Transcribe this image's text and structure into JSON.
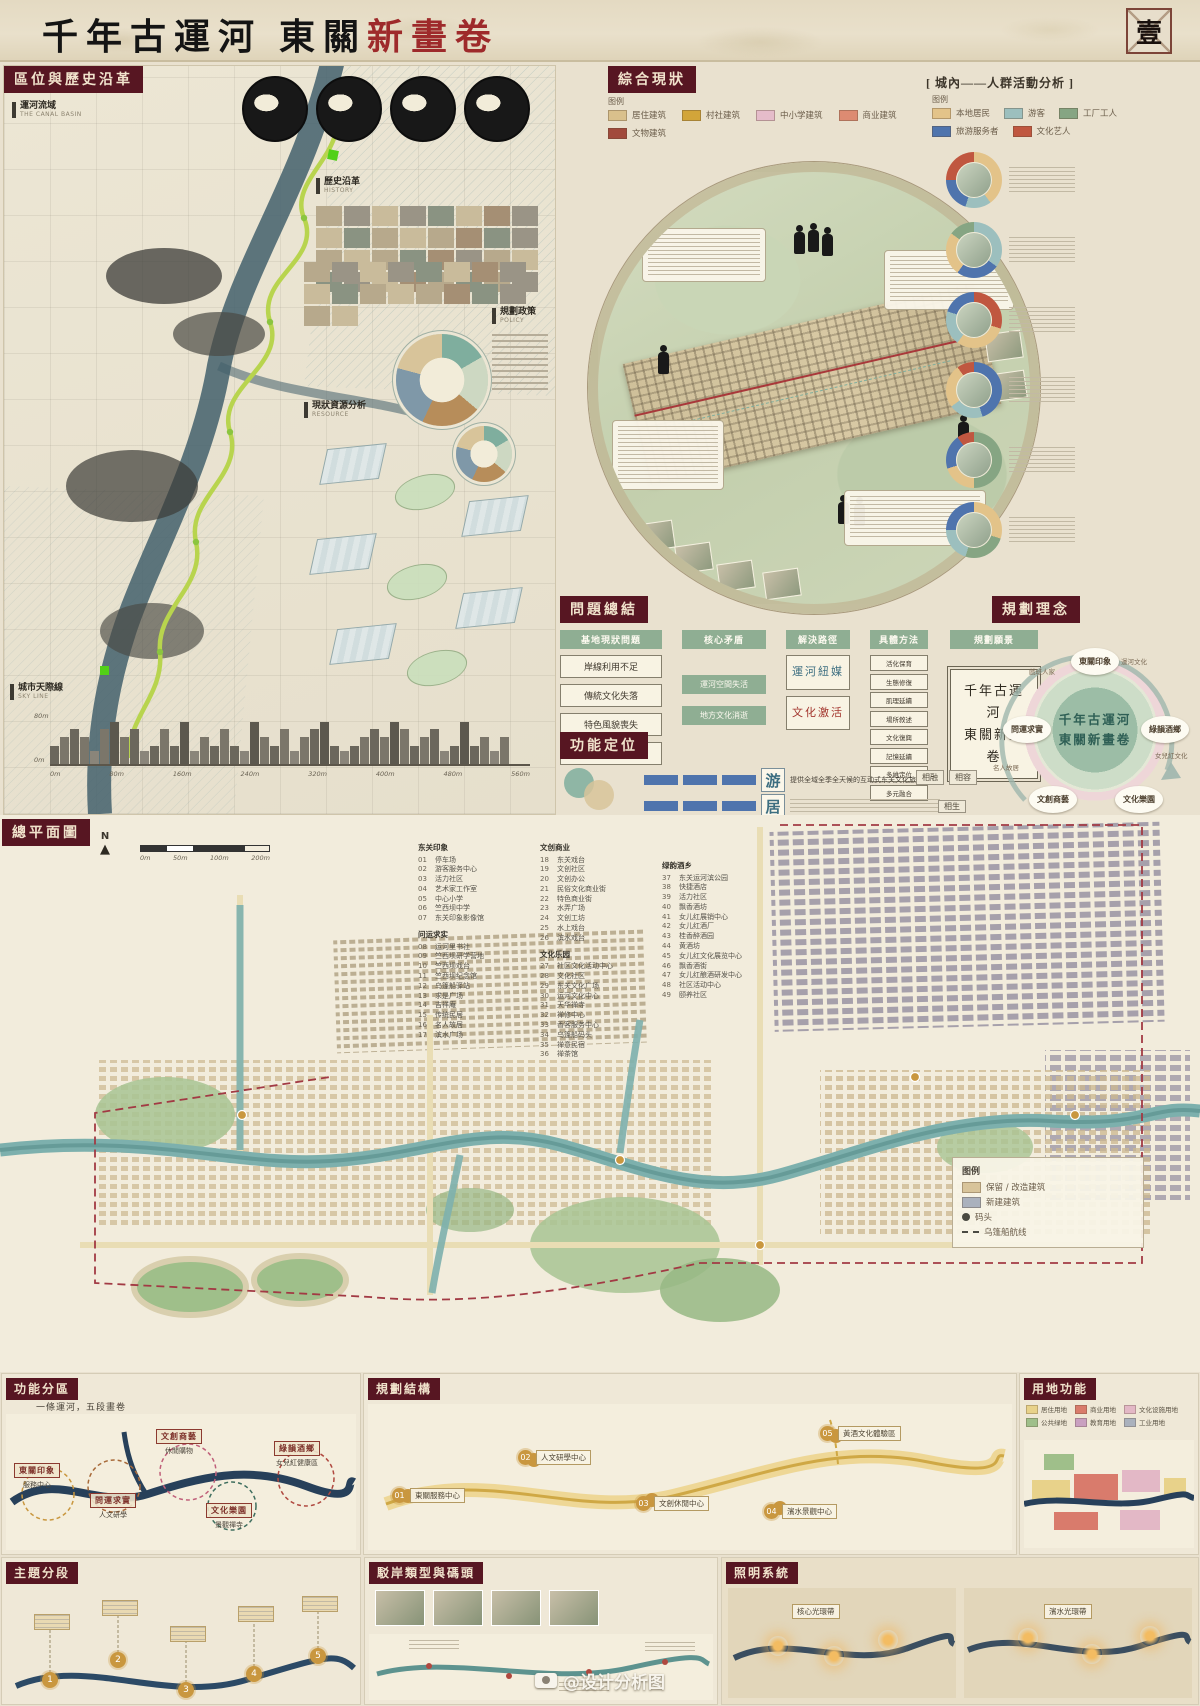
{
  "header": {
    "title_prefix": "千年古運河  東關",
    "title_accent": "新畫卷",
    "folio": "壹"
  },
  "left_panel": {
    "section_title": "區位與歷史沿革",
    "labels": [
      {
        "zh": "運河流域",
        "en": "THE CANAL BASIN"
      },
      {
        "zh": "歷史沿革",
        "en": "HISTORY"
      },
      {
        "zh": "規劃政策",
        "en": "POLICY"
      },
      {
        "zh": "現狀資源分析",
        "en": "RESOURCE"
      },
      {
        "zh": "城市天際線",
        "en": "SKY LINE"
      }
    ],
    "elev_marks": [
      "80m",
      "0m"
    ],
    "dist_marks": [
      "0m",
      "80m",
      "160m",
      "240m",
      "320m",
      "400m",
      "480m",
      "560m"
    ]
  },
  "status": {
    "section_title": "綜合現狀",
    "legend_title": "图例",
    "legend": [
      {
        "label": "居住建筑",
        "color": "#d9c08c"
      },
      {
        "label": "村社建筑",
        "color": "#d2a53a"
      },
      {
        "label": "中小学建筑",
        "color": "#e5bcca"
      },
      {
        "label": "商业建筑",
        "color": "#dd8b72"
      },
      {
        "label": "文物建筑",
        "color": "#a14a3c"
      }
    ]
  },
  "crowd": {
    "section_title": "[ 城內——人群活動分析 ]",
    "legend_title": "图例",
    "legend": [
      {
        "label": "本地居民",
        "color": "#e3c389"
      },
      {
        "label": "游客",
        "color": "#9cbfbe"
      },
      {
        "label": "工厂工人",
        "color": "#86a583"
      },
      {
        "label": "旅游服务者",
        "color": "#4f74ad"
      },
      {
        "label": "文化艺人",
        "color": "#c05740"
      }
    ]
  },
  "problems": {
    "section_title": "問題總結",
    "col_site": {
      "title": "基地現狀問題",
      "items": [
        "岸線利用不足",
        "傳統文化失落",
        "特色風貌喪失",
        "社會生活隔閡"
      ]
    },
    "col_core": {
      "title": "核心矛盾",
      "items": [
        "運河空間失活",
        "地方文化消逝"
      ]
    },
    "col_path": {
      "title": "解決路徑"
    },
    "path_item1": "運河紐媒",
    "path_item2": "文化激活",
    "col_method": {
      "title": "具體方法",
      "items": [
        "活化保育",
        "生態修復",
        "肌理延續",
        "場所敘述",
        "文化復興",
        "記憶延續",
        "多維定位",
        "多元融合"
      ]
    },
    "col_vision": {
      "title": "規劃願景",
      "line1": "千年古運河",
      "line2": "東關新畫卷"
    }
  },
  "positioning": {
    "section_title": "功能定位",
    "row1_char": "游",
    "row1_desc": "提供全域全季全天候的互动式东关文化旅游服务",
    "row2_char": "居",
    "relations": [
      "相融",
      "相容",
      "相生"
    ]
  },
  "concept": {
    "section_title": "規劃理念",
    "center_line1": "千年古運河",
    "center_line2": "東關新畫卷",
    "bubbles": [
      "東關印象",
      "問運求實",
      "綠韻酒鄉",
      "文創商藝",
      "文化樂園"
    ],
    "ring_labels": [
      "戲班人家",
      "運河文化",
      "名人故居",
      "古碼頭",
      "女兒紅文化",
      "烏篷船之旅"
    ]
  },
  "masterplan": {
    "section_title": "總平面圖",
    "north_label": "N",
    "scale_labels": [
      "0m",
      "50m",
      "100m",
      "200m"
    ],
    "groups": [
      {
        "title": "东关印象",
        "items": [
          {
            "no": "01",
            "name": "停车场"
          },
          {
            "no": "02",
            "name": "游客服务中心"
          },
          {
            "no": "03",
            "name": "活力社区"
          },
          {
            "no": "04",
            "name": "艺术家工作室"
          },
          {
            "no": "05",
            "name": "中心小学"
          },
          {
            "no": "06",
            "name": "竺西坝中学"
          },
          {
            "no": "07",
            "name": "东关印象影像馆"
          }
        ]
      },
      {
        "title": "问运求实",
        "items": [
          {
            "no": "08",
            "name": "运河里书社"
          },
          {
            "no": "09",
            "name": "竺西坝研学营地"
          },
          {
            "no": "10",
            "name": "竺西坝戏台"
          },
          {
            "no": "11",
            "name": "竺西坝纪念馆"
          },
          {
            "no": "12",
            "name": "乌篷船驿站"
          },
          {
            "no": "13",
            "name": "求是广场"
          },
          {
            "no": "14",
            "name": "吉祥庵"
          },
          {
            "no": "15",
            "name": "传统民居"
          },
          {
            "no": "16",
            "name": "名人故居"
          },
          {
            "no": "17",
            "name": "滨水广场"
          }
        ]
      },
      {
        "title": "文创商业",
        "items": [
          {
            "no": "18",
            "name": "东关戏台"
          },
          {
            "no": "19",
            "name": "文创社区"
          },
          {
            "no": "20",
            "name": "文创办公"
          },
          {
            "no": "21",
            "name": "民俗文化商业街"
          },
          {
            "no": "22",
            "name": "特色商业街"
          },
          {
            "no": "23",
            "name": "水弄广场"
          },
          {
            "no": "24",
            "name": "文创工坊"
          },
          {
            "no": "25",
            "name": "水上戏台"
          },
          {
            "no": "26",
            "name": "滨水戏台"
          }
        ]
      },
      {
        "title": "文化乐园",
        "items": [
          {
            "no": "27",
            "name": "社区文化活动中心"
          },
          {
            "no": "28",
            "name": "文化社区"
          },
          {
            "no": "29",
            "name": "东关文化广场"
          },
          {
            "no": "30",
            "name": "运河文化中心"
          },
          {
            "no": "31",
            "name": "天华禅寺"
          },
          {
            "no": "32",
            "name": "禅修中心"
          },
          {
            "no": "33",
            "name": "香客服务中心"
          },
          {
            "no": "34",
            "name": "乌篷船码头"
          },
          {
            "no": "35",
            "name": "禅意民宿"
          },
          {
            "no": "36",
            "name": "禅茶馆"
          }
        ]
      },
      {
        "title": "绿韵酒乡",
        "items": [
          {
            "no": "37",
            "name": "东关运河滨公园"
          },
          {
            "no": "38",
            "name": "快捷酒店"
          },
          {
            "no": "39",
            "name": "活力社区"
          },
          {
            "no": "40",
            "name": "飘香酒坊"
          },
          {
            "no": "41",
            "name": "女儿红展销中心"
          },
          {
            "no": "42",
            "name": "女儿红酒厂"
          },
          {
            "no": "43",
            "name": "桂香醉酒园"
          },
          {
            "no": "44",
            "name": "黄酒坊"
          },
          {
            "no": "45",
            "name": "女儿红文化展览中心"
          },
          {
            "no": "46",
            "name": "飘香酒街"
          },
          {
            "no": "47",
            "name": "女儿红酿酒研发中心"
          },
          {
            "no": "48",
            "name": "社区活动中心"
          },
          {
            "no": "49",
            "name": "颐养社区"
          }
        ]
      }
    ],
    "legend_title": "图例",
    "legend_keep": "保留 / 改造建筑",
    "legend_new": "新建建筑",
    "legend_dock": "码头",
    "legend_route": "乌篷船航线"
  },
  "zones": {
    "section_title": "功能分區",
    "subtitle": "一條運河，五段畫卷",
    "pairs": [
      {
        "zone": "東關印象",
        "sub": "服務中心"
      },
      {
        "zone": "問運求實",
        "sub": "人文研學"
      },
      {
        "zone": "文創商藝",
        "sub": "休閒購物"
      },
      {
        "zone": "文化樂園",
        "sub": "景觀禪寺"
      },
      {
        "zone": "綠韻酒鄉",
        "sub": "女兒紅健康區"
      }
    ]
  },
  "structure": {
    "section_title": "規劃結構",
    "nodes": [
      {
        "no": "01",
        "name": "東關服務中心"
      },
      {
        "no": "02",
        "name": "人文研學中心"
      },
      {
        "no": "03",
        "name": "文創休閒中心"
      },
      {
        "no": "04",
        "name": "濱水景觀中心"
      },
      {
        "no": "05",
        "name": "黃酒文化體驗區"
      }
    ]
  },
  "landuse": {
    "section_title": "用地功能",
    "legend": [
      {
        "label": "居住用地",
        "color": "#e8d28a"
      },
      {
        "label": "商业用地",
        "color": "#d97b6c"
      },
      {
        "label": "文化设施用地",
        "color": "#e3b8c6"
      },
      {
        "label": "公共绿地",
        "color": "#9fbf8a"
      },
      {
        "label": "教育用地",
        "color": "#c9a0c0"
      },
      {
        "label": "工业用地",
        "color": "#aab1bd"
      }
    ]
  },
  "themes": {
    "section_title": "主題分段",
    "numbers": [
      "1",
      "2",
      "3",
      "4",
      "5"
    ]
  },
  "revetment": {
    "section_title": "駁岸類型與碼頭"
  },
  "lighting": {
    "section_title": "照明系統",
    "labels": [
      "核心光環帶",
      "濱水光環帶"
    ]
  },
  "watermark": {
    "text": "@设计分析图"
  }
}
